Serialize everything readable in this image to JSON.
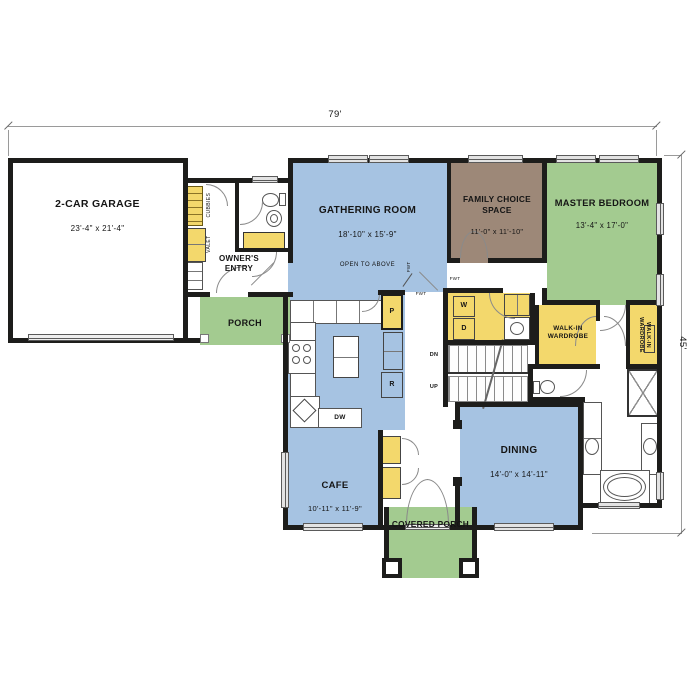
{
  "dims": {
    "width": "79'",
    "depth": "45'"
  },
  "colors": {
    "living": "#a6c3e2",
    "outdoor": "#a3cb90",
    "flex": "#9d8878",
    "storage": "#f3d86c",
    "wall": "#1d1d1b"
  },
  "rooms": {
    "garage": {
      "name": "2-CAR GARAGE",
      "size": "23'-4\" x 21'-4\""
    },
    "gathering": {
      "name": "GATHERING ROOM",
      "size": "18'-10\" x 15'-9\"",
      "note": "OPEN TO ABOVE"
    },
    "family_choice": {
      "name": "FAMILY CHOICE SPACE",
      "size": "11'-0\" x 11'-10\""
    },
    "master_bedroom": {
      "name": "MASTER BEDROOM",
      "size": "13'-4\" x 17'-0\""
    },
    "cafe": {
      "name": "CAFE",
      "size": "10'-11\" x 11'-9\""
    },
    "dining": {
      "name": "DINING",
      "size": "14'-0\" x 14'-11\""
    },
    "owners_entry": {
      "name": "OWNER'S\nENTRY"
    },
    "porch": {
      "name": "PORCH"
    },
    "covered_porch": {
      "name": "COVERED PORCH"
    },
    "wic_master": {
      "name": "WALK-IN\nWARDROBE"
    },
    "wic_master2": {
      "name": "WALK-IN\nWARDROBE"
    }
  },
  "fixtures": {
    "washer": "W",
    "dryer": "D",
    "pantry": "P",
    "fridge": "R",
    "dishwasher": "DW",
    "stairs_down": "DN",
    "stairs_up": "UP",
    "cubbies": "CUBBIES",
    "valet": "VALET",
    "fwt": "FWT"
  }
}
